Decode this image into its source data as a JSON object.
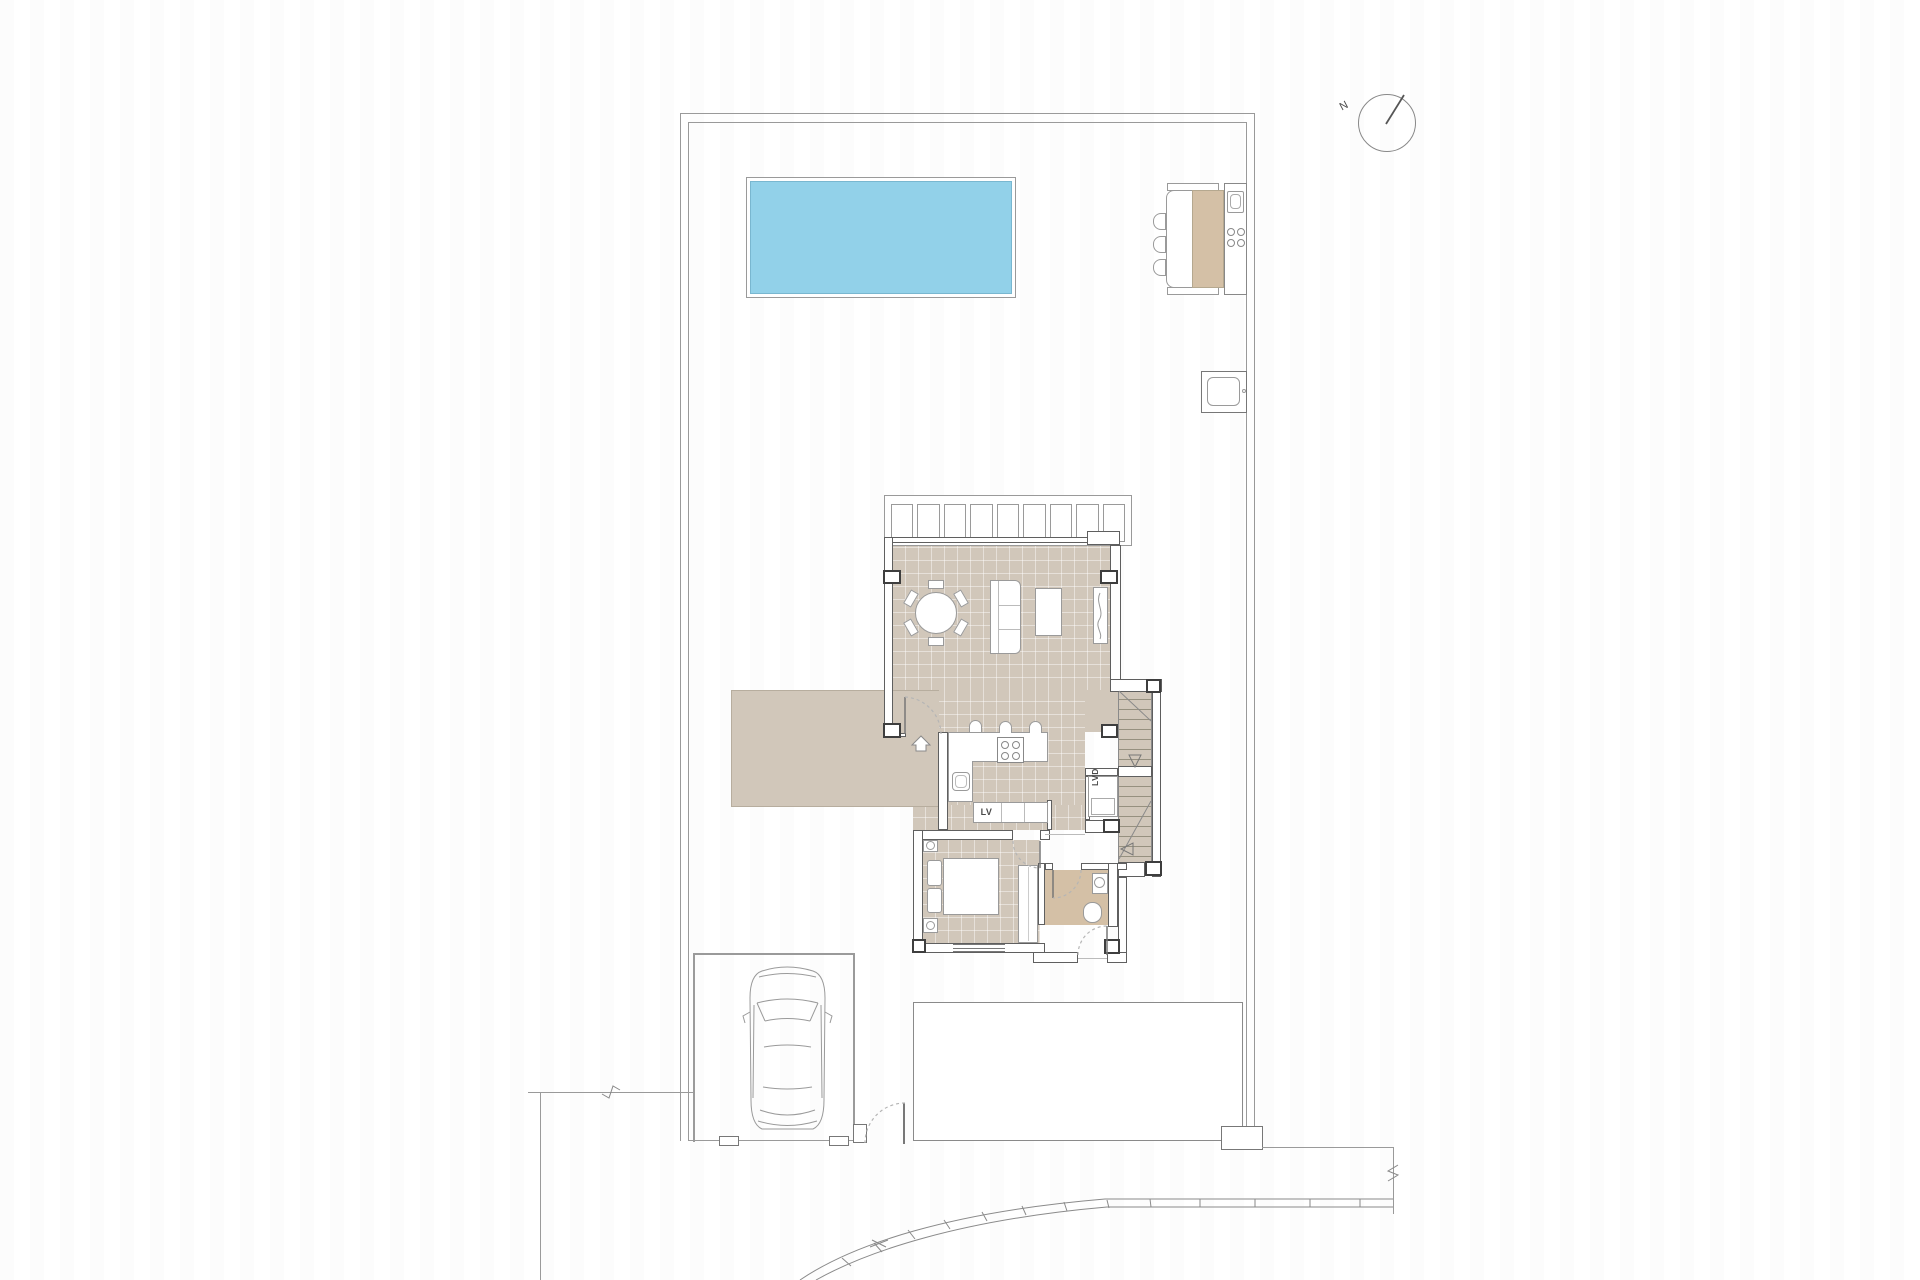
{
  "labels": {
    "dishwasher": "LV",
    "laundry": "LVD",
    "north": "N"
  },
  "colors": {
    "floor_tan": "#d1c7ba",
    "bath_tan": "#d4c0a6",
    "pool_blue": "#92d1e9",
    "pool_edge": "#79b7d0",
    "wall_gray": "#5f5f5f",
    "line_gray": "#9a9a9a",
    "label_gray": "#4a4a4a"
  }
}
